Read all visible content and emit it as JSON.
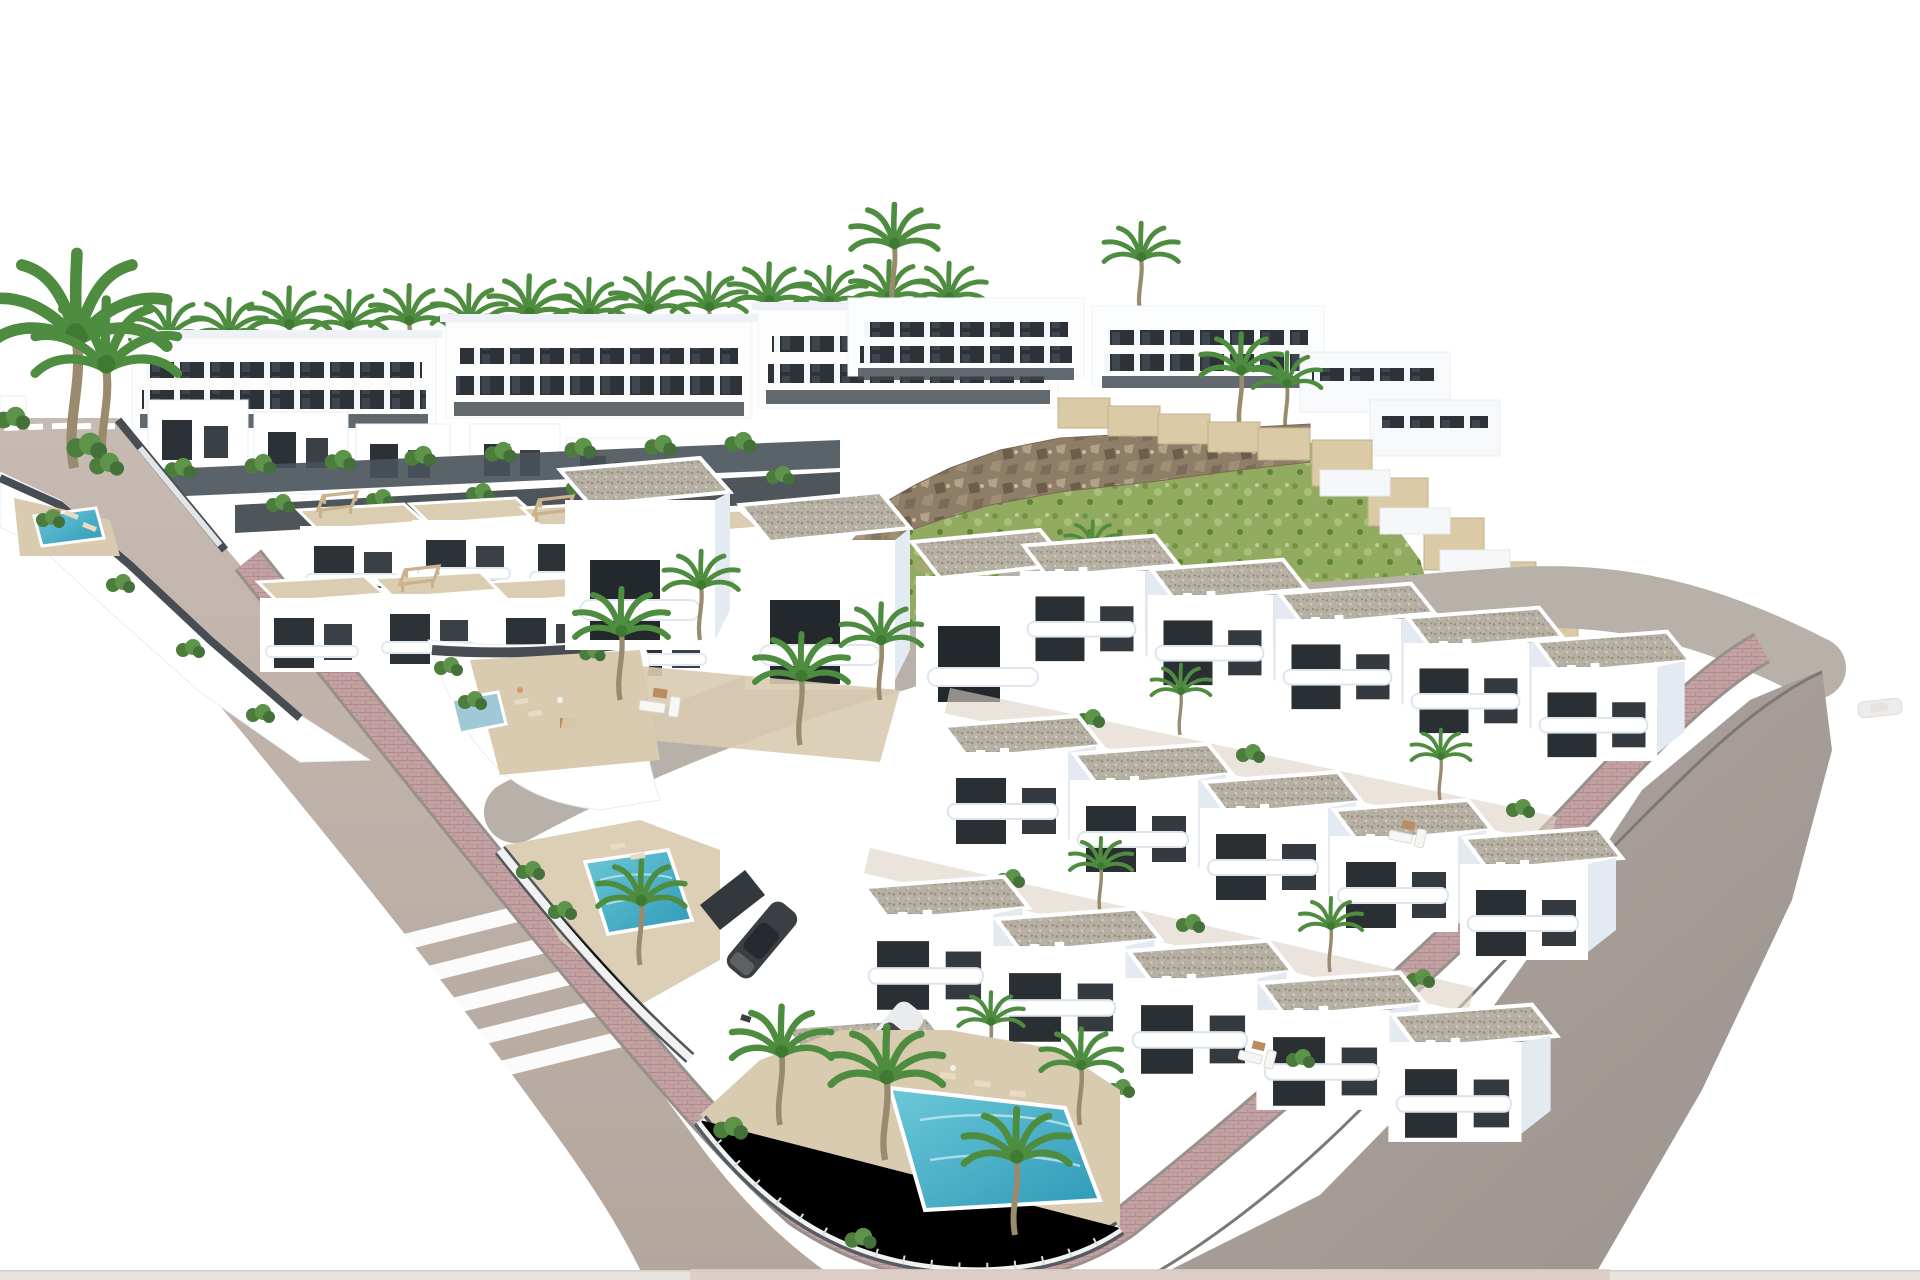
{
  "meta": {
    "type": "architectural-3d-render",
    "subject": "Aerial 3D render of a new-build residential development: rows of white modern villas with gravel flat roofs, private pools, palm trees, a green rocky hillside and freshly paved roads with pink brick sidewalks on a white background",
    "no_visible_text": true
  },
  "palette": {
    "background": "#ffffff",
    "road": "#c0b4ab",
    "road_deep": "#b0a49b",
    "road_right": "#a79d98",
    "road_right_deep": "#978d88",
    "road_internal": "#b8b1a9",
    "sidewalk": "#c4a2a3",
    "sidewalk_light": "#d5b8b6",
    "curb": "#8e8883",
    "marking_white": "#ffffff",
    "building_white": "#ffffff",
    "building_shade": "#e4eaf1",
    "parapet": "#eef2f6",
    "window_dark": "#2b3136",
    "window_mid": "#3a4046",
    "gravel_roof": "#b7b0a4",
    "terrace_beige": "#d9cbb0",
    "terrace_light": "#dbcdb2",
    "fence_dark": "#474d52",
    "plinth_dark": "#49525a",
    "glass_fence": "#ffffff",
    "hill_green": "#92ab60",
    "veg_green": "#5d944a",
    "veg_dark": "#44703a",
    "palm_green": "#4e8c3f",
    "trunk_brown": "#9a8a6e",
    "rock": "#8f7e67",
    "rock_light": "#b3a28a",
    "rock_dark": "#6d5e4c",
    "wall_tan": "#dbcaa6",
    "pool": "#3fb0c6",
    "pool_pale": "#9fc9d6",
    "car_dark": "#3b3f43",
    "car_white": "#e9ebed",
    "car_ghost": "#e6e3e0",
    "wood": "#b98d5f",
    "lounger": "#e8dbc2",
    "skin": "#d9976b",
    "bottom_strip": "#e9e3de",
    "bottom_strip_pink": "#decbc6"
  },
  "scene": {
    "roads": {
      "left_road": {
        "lane_dashes": 5,
        "crosswalk_stripes": 5,
        "runs": "from top-left corner diagonally to bottom centre"
      },
      "internal_road": {
        "shape": "s-curve with white keyhole island between villa blocks"
      },
      "right_road": {
        "runs": "from upper right down to bottom edge",
        "sidewalk": "pink brick"
      }
    },
    "vegetation": {
      "tall_twin_palms_top_left": 2,
      "palm_row_behind_apartments": 14,
      "scattered_palms": 20,
      "shrubs": 30,
      "hillside": "green scrub slope with rocky cliff crest and dirt patches"
    },
    "buildings": {
      "top_apartment_slabs": 3,
      "hilltop_slabs": 4,
      "front_small_villas": 5,
      "roadside_strip_plots": 2,
      "middle_terrace_villas": 8,
      "detached_villas": 3,
      "foreground_row_units": [
        5,
        5,
        5,
        2
      ],
      "corner_plots_with_pools": 2
    },
    "pools": [
      {
        "id": "left-strip-pool",
        "color_key": "pool"
      },
      {
        "id": "middle-block-corner-pool",
        "color_key": "pool_pale"
      },
      {
        "id": "foreground-left-pool",
        "color_key": "pool"
      },
      {
        "id": "foreground-corner-pool",
        "color_key": "pool"
      }
    ],
    "vehicles": [
      {
        "id": "dark-suv",
        "color_key": "car_dark"
      },
      {
        "id": "white-suv",
        "color_key": "car_white"
      },
      {
        "id": "ghost-car-right-edge",
        "color_key": "car_ghost"
      }
    ],
    "walls": {
      "stepped_tan_retaining_walls": 2,
      "dark_plot_fences": "dark grey with glass panels on street corners"
    }
  }
}
